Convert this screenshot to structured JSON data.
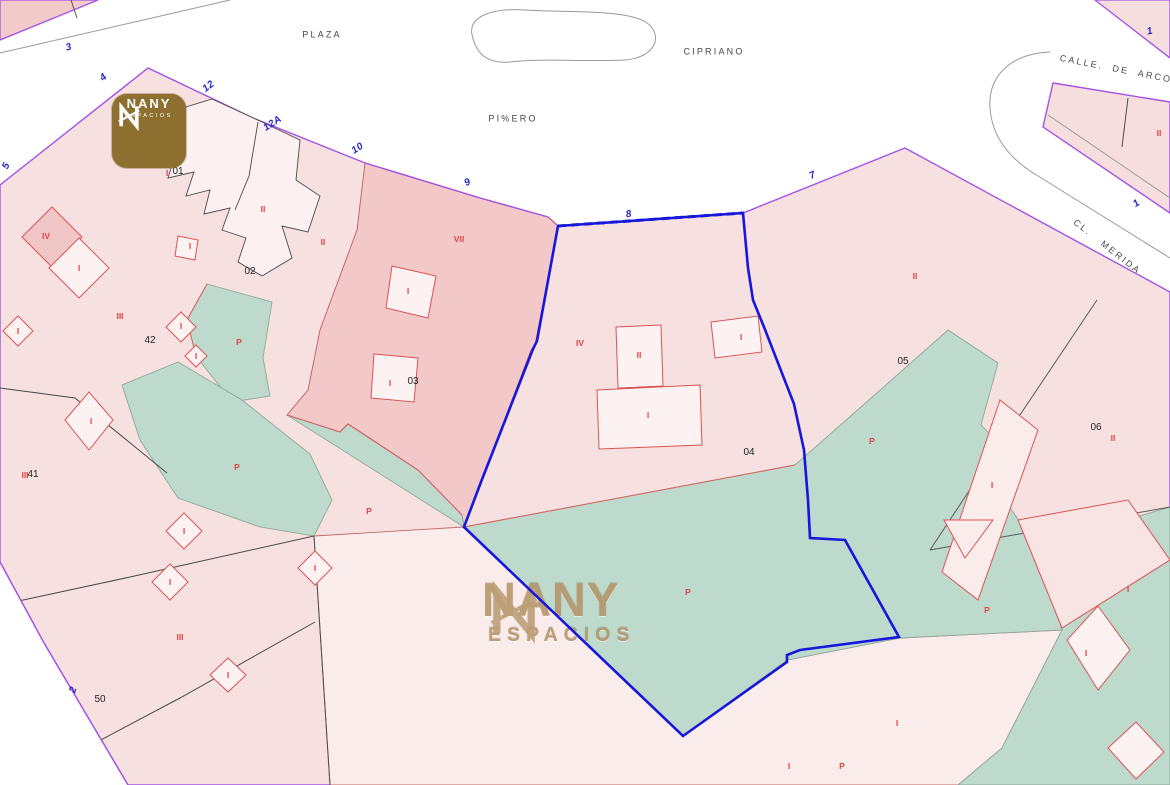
{
  "brand": {
    "name": "NANY",
    "tagline": "ESPACIOS"
  },
  "watermark": {
    "name": "NANY",
    "tagline": "ESPACIOS"
  },
  "colors": {
    "parcel_pink": "#f7e0e0",
    "parcel_dark_pink": "#f2c8c8",
    "building_light": "#fdf2f2",
    "courtyard_green": "#bedacd",
    "street_white": "#ffffff",
    "boundary_purple": "#a352e6",
    "selection_blue": "#1616dd",
    "building_red": "#d95454",
    "parcel_gray": "#5a5a5a",
    "brand_gold": "#8d7030"
  },
  "labels": {
    "streets": [
      {
        "text": "PLAZA",
        "x": 322,
        "y": 35,
        "rot": 0
      },
      {
        "text": "CIPRIANO",
        "x": 714,
        "y": 52,
        "rot": 0
      },
      {
        "text": "PI%ERO",
        "x": 513,
        "y": 119,
        "rot": 0
      },
      {
        "text": "CALLE.  DE  ARCOS",
        "x": 1120,
        "y": 70,
        "rot": 11
      },
      {
        "text": "CL.   MERIDA",
        "x": 1107,
        "y": 247,
        "rot": 38
      }
    ],
    "house_numbers": [
      {
        "text": "3",
        "x": 69,
        "y": 48,
        "rot": -15
      },
      {
        "text": "4",
        "x": 104,
        "y": 78,
        "rot": -40
      },
      {
        "text": "12",
        "x": 209,
        "y": 87,
        "rot": -38
      },
      {
        "text": "12A",
        "x": 273,
        "y": 124,
        "rot": -33
      },
      {
        "text": "5",
        "x": 7,
        "y": 166,
        "rot": -65
      },
      {
        "text": "10",
        "x": 358,
        "y": 149,
        "rot": -33
      },
      {
        "text": "9",
        "x": 468,
        "y": 183,
        "rot": -28
      },
      {
        "text": "8",
        "x": 629,
        "y": 215,
        "rot": -10
      },
      {
        "text": "7",
        "x": 813,
        "y": 176,
        "rot": -25
      },
      {
        "text": "1",
        "x": 1150,
        "y": 32,
        "rot": -12
      },
      {
        "text": "1",
        "x": 1137,
        "y": 204,
        "rot": -35
      },
      {
        "text": "2",
        "x": 74,
        "y": 690,
        "rot": -70
      }
    ],
    "parcel_numbers": [
      {
        "text": "01",
        "x": 178,
        "y": 172,
        "rot": 0
      },
      {
        "text": "02",
        "x": 250,
        "y": 272,
        "rot": 0
      },
      {
        "text": "42",
        "x": 150,
        "y": 341,
        "rot": 0
      },
      {
        "text": "03",
        "x": 413,
        "y": 382,
        "rot": 0
      },
      {
        "text": "04",
        "x": 749,
        "y": 453,
        "rot": 0
      },
      {
        "text": "05",
        "x": 903,
        "y": 362,
        "rot": 0
      },
      {
        "text": "06",
        "x": 1096,
        "y": 428,
        "rot": 0
      },
      {
        "text": "41",
        "x": 33,
        "y": 475,
        "rot": 0
      },
      {
        "text": "50",
        "x": 100,
        "y": 700,
        "rot": 0
      }
    ],
    "building_marks": [
      {
        "text": "IV",
        "x": 46,
        "y": 236,
        "rot": 0
      },
      {
        "text": "I",
        "x": 79,
        "y": 268,
        "rot": 0
      },
      {
        "text": "I",
        "x": 18,
        "y": 331,
        "rot": 0
      },
      {
        "text": "III",
        "x": 120,
        "y": 316,
        "rot": 0
      },
      {
        "text": "I",
        "x": 91,
        "y": 421,
        "rot": 0
      },
      {
        "text": "I",
        "x": 181,
        "y": 326,
        "rot": 0
      },
      {
        "text": "I",
        "x": 196,
        "y": 356,
        "rot": 0
      },
      {
        "text": "I",
        "x": 190,
        "y": 246,
        "rot": 0
      },
      {
        "text": "I",
        "x": 167,
        "y": 173,
        "rot": 0
      },
      {
        "text": "II",
        "x": 263,
        "y": 209,
        "rot": 0
      },
      {
        "text": "II",
        "x": 323,
        "y": 242,
        "rot": 0
      },
      {
        "text": "VII",
        "x": 459,
        "y": 239,
        "rot": 0
      },
      {
        "text": "I",
        "x": 408,
        "y": 291,
        "rot": 0
      },
      {
        "text": "I",
        "x": 390,
        "y": 383,
        "rot": 0
      },
      {
        "text": "IV",
        "x": 580,
        "y": 343,
        "rot": 0
      },
      {
        "text": "II",
        "x": 639,
        "y": 355,
        "rot": 0
      },
      {
        "text": "I",
        "x": 648,
        "y": 415,
        "rot": 0
      },
      {
        "text": "I",
        "x": 741,
        "y": 337,
        "rot": 0
      },
      {
        "text": "II",
        "x": 915,
        "y": 276,
        "rot": 0
      },
      {
        "text": "II",
        "x": 1159,
        "y": 133,
        "rot": 0
      },
      {
        "text": "II",
        "x": 1113,
        "y": 438,
        "rot": 0
      },
      {
        "text": "I",
        "x": 992,
        "y": 485,
        "rot": 0
      },
      {
        "text": "I",
        "x": 1128,
        "y": 589,
        "rot": 0
      },
      {
        "text": "I",
        "x": 1086,
        "y": 653,
        "rot": 0
      },
      {
        "text": "I",
        "x": 897,
        "y": 723,
        "rot": 0
      },
      {
        "text": "I",
        "x": 789,
        "y": 766,
        "rot": 0
      },
      {
        "text": "III",
        "x": 25,
        "y": 475,
        "rot": 0
      },
      {
        "text": "III",
        "x": 180,
        "y": 637,
        "rot": 0
      },
      {
        "text": "I",
        "x": 228,
        "y": 675,
        "rot": 0
      },
      {
        "text": "I",
        "x": 315,
        "y": 568,
        "rot": 0
      },
      {
        "text": "I",
        "x": 184,
        "y": 531,
        "rot": 0
      },
      {
        "text": "I",
        "x": 170,
        "y": 582,
        "rot": 0
      },
      {
        "text": "P",
        "x": 239,
        "y": 342,
        "rot": 0
      },
      {
        "text": "P",
        "x": 237,
        "y": 467,
        "rot": 0
      },
      {
        "text": "P",
        "x": 369,
        "y": 511,
        "rot": 0
      },
      {
        "text": "P",
        "x": 872,
        "y": 441,
        "rot": 0
      },
      {
        "text": "P",
        "x": 987,
        "y": 610,
        "rot": 0
      },
      {
        "text": "P",
        "x": 842,
        "y": 766,
        "rot": 0
      },
      {
        "text": "P",
        "x": 688,
        "y": 592,
        "rot": 0
      }
    ]
  }
}
